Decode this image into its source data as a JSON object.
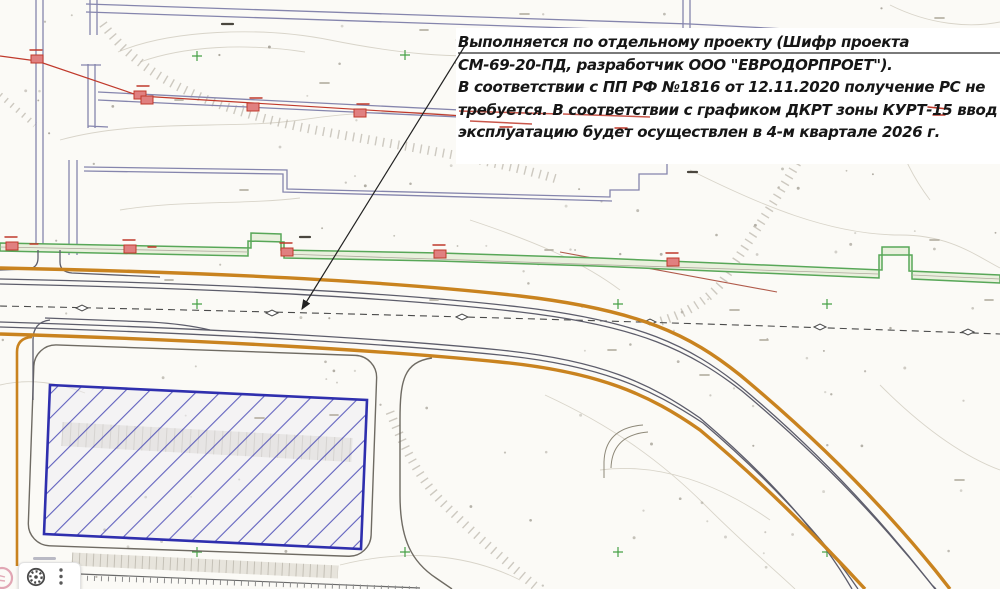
{
  "annotation": {
    "lines": [
      "Выполняется по отдельному проекту (Шифр проекта",
      "СМ-69-20-ПД, разработчик ООО \"ЕВРОДОРПРОЕТ\").",
      "В соответствии с ПП РФ №1816 от 12.11.2020 получение РС не",
      "требуется. В соответствии с графиком ДКРТ зоны КУРТ-15 ввод в",
      "эксплуатацию будет осуществлен в 4-м квартале 2026 г."
    ]
  },
  "legend_colors": {
    "road_edge_orange": "#c9831f",
    "utility_line_purple": "#8585ad",
    "fence_green": "#58a758",
    "building_hatch_blue": "#2f2fae",
    "existing_network_red": "#c0392b",
    "alignment_axis_gray": "#4a4a4a",
    "paper": "#fbfaf6"
  },
  "overlay": {
    "gear_icon": "gear-icon",
    "more_icon": "vertical-ellipsis-icon",
    "stamp_icon": "pink-stamp-icon"
  }
}
